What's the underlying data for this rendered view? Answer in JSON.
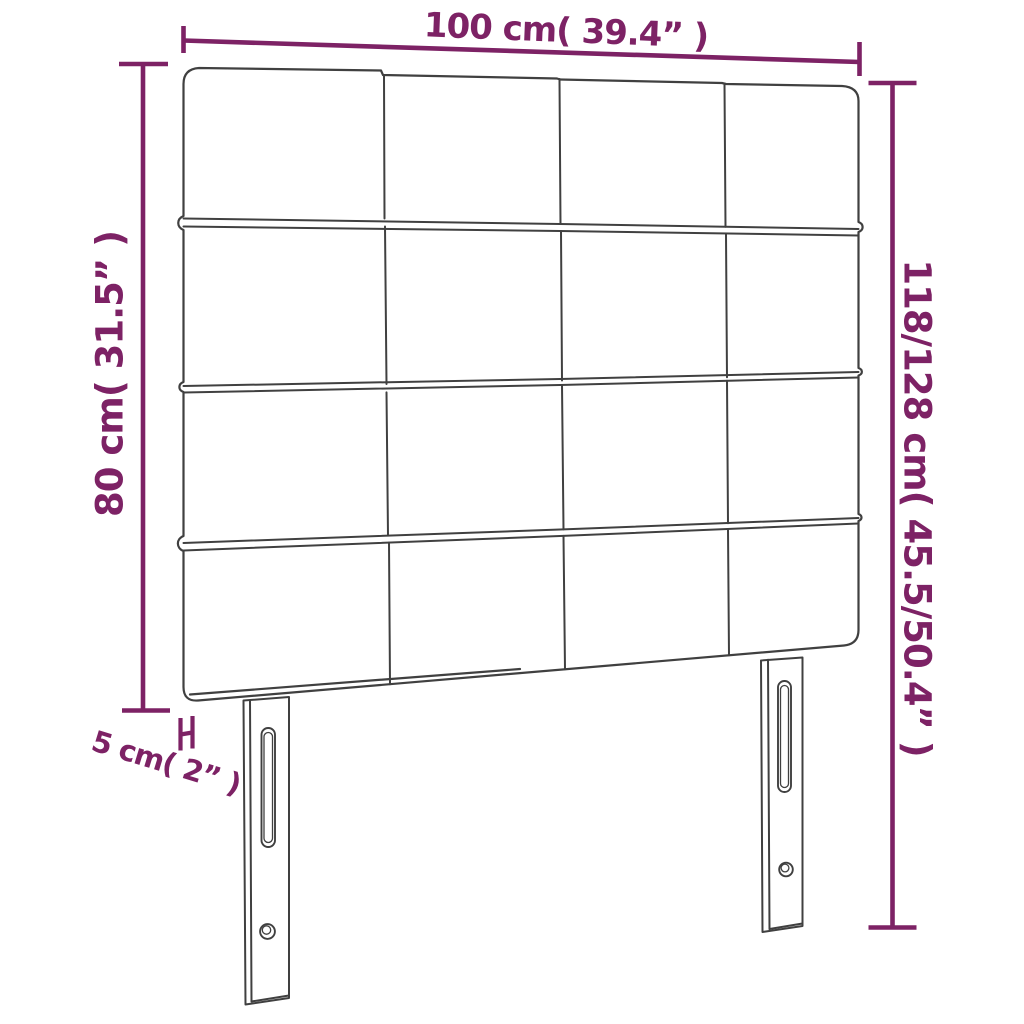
{
  "colors": {
    "accent": "#7d2265",
    "line": "#404040",
    "background": "#ffffff"
  },
  "labels": {
    "width": "100 cm( 39.4” )",
    "height_left": "80 cm( 31.5” )",
    "height_right": "118/128 cm( 45.5/50.4” )",
    "depth": "5 cm( 2” )"
  },
  "figure": {
    "type": "headboard",
    "panel_rows": 4,
    "panel_columns": 4,
    "legs": 2,
    "slots_per_leg": 1,
    "screw_holes_per_leg": 1
  }
}
